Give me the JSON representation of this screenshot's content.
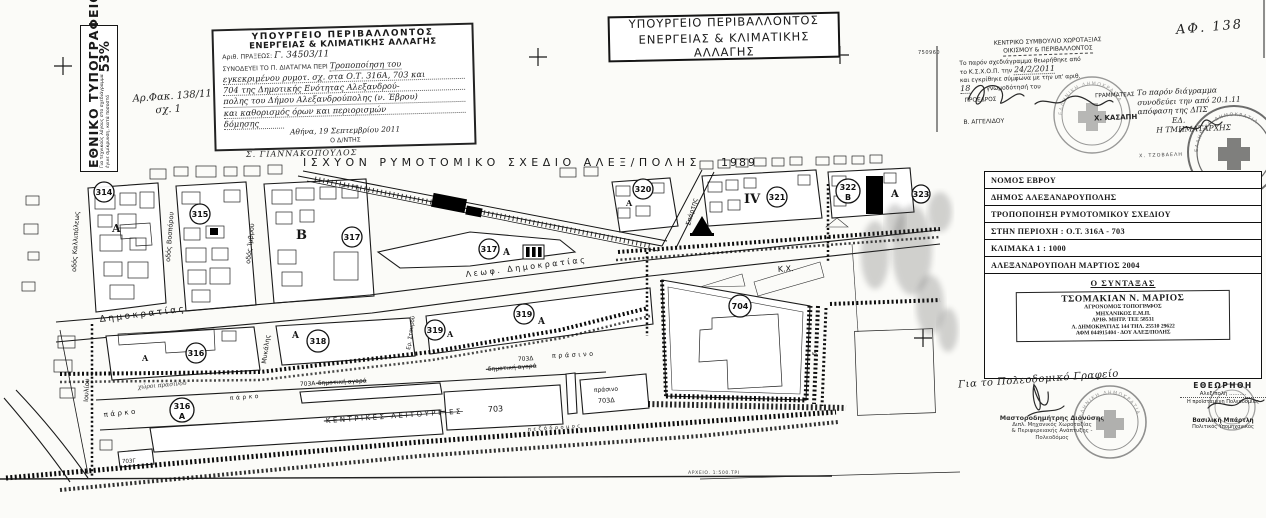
{
  "scan": {
    "archive_note": "ΑΡΧΕΙΟ. 1:500.ΤΡΙ",
    "doc_number": "750960",
    "ring_text": "ΕΛΛΗΝΙΚΗ ΔΗΜΟΚΡΑΤΙΑ"
  },
  "printing_office": {
    "title": "ΕΘΝΙΚΟ ΤΥΠΟΓΡΑΦΕΙΟ",
    "note1": "Για τεχνικούς λόγους στο σχεδιάγραμμα",
    "note2": "έγινε σμίκρυνση, κατά ποσοστό",
    "percent": "53%"
  },
  "file_ref": {
    "line1": "Αρ.Φακ. 138/11",
    "line2": "σχ. 1"
  },
  "ministry_stamp": {
    "title1": "ΥΠΟΥΡΓΕΙΟ ΠΕΡΙΒΑΛΛΟΝΤΟΣ",
    "title2": "ΕΝΕΡΓΕΙΑΣ & ΚΛΙΜΑΤΙΚΗΣ ΑΛΛΑΓΗΣ",
    "praxis_label": "Αριθ. ΠΡΑΞΕΩΣ:",
    "praxis_value": "Γ. 34503/11",
    "accompanies": "ΣΥΝΟΔΕΥΕΙ ΤΟ Π. ΔΙΑΤΑΓΜΑ ΠΕΡΙ",
    "hw1": "Τροποποίηση του",
    "hw2": "εγκεκριμένου ρυμοτ. σχ. στα Ο.Τ. 316Α, 703 και",
    "hw3": "704 της Δημοτικής Ενότητας Αλεξανδρού-",
    "hw4": "πολης του Δήμου Αλεξανδρούπολης (ν. Έβρου)",
    "hw5": "και καθορισμός όρων και περιορισμών",
    "hw6": "δόμησης",
    "date_line": "Αθήνα, 19 Σεπτεμβρίου 2011",
    "signer_title": "Ο Δ/ΝΤΗΣ",
    "signer_name": "Σ. ΓΙΑΝΝΑΚΟΠΟΥΛΟΣ"
  },
  "ministry_box": {
    "line1": "ΥΠΟΥΡΓΕΙΟ ΠΕΡΙΒΑΛΛΟΝΤΟΣ",
    "line2": "ΕΝΕΡΓΕΙΑΣ & ΚΛΙΜΑΤΙΚΗΣ ΑΛΛΑΓΗΣ"
  },
  "council_stamp": {
    "line1": "ΚΕΝΤΡΙΚΟ ΣΥΜΒΟΥΛΙΟ ΧΩΡΟΤΑΞΙΑΣ",
    "line2": "ΟΙΚΙΣΜΟΥ & ΠΕΡΙΒΑΛΛΟΝΤΟΣ",
    "body1": "Το παρόν σχεδιάγραμμα θεωρήθηκε από",
    "body2a": "το Κ.Σ.Χ.Ο.Π. την",
    "body2b": "24/2/2011",
    "body3": "και εγκρίθηκε σύμφωνα με την υπ' αριθ.",
    "body4a": "18",
    "body4b": "γνωμοδότησή του",
    "president_label": "ΠΡΟΕΔΡΟΣ",
    "secretary_label": "ΓΡΑΜΜΑΤΕΑΣ",
    "president_name": "Β. ΑΓΓΕΛΙΔΟΥ",
    "secretary_name": "Χ. ΚΑΣΑΠΗ"
  },
  "ref_number": "ΑΦ. 138",
  "side_note": {
    "line1": "Το παρόν διάγραμμα",
    "line2": "συνοδεύει την από 20.1.11",
    "line3": "απόφαση της ΔΠΣ",
    "line4": "ΕΔ.",
    "line5": "Η ΤΜΗΜΑΤΑΡΧΗΣ",
    "line6": "Χ. ΤΖΟΒΑΕΛΗ"
  },
  "map": {
    "title": "ΙΣΧΥΟΝ ΡΥΜΟΤΟΜΙΚΟ ΣΧΕΔΙΟ ΑΛΕΞ/ΠΟΛΗΣ",
    "year": "1989",
    "markers": [
      {
        "n": "314",
        "x": 104,
        "y": 192
      },
      {
        "n": "315",
        "x": 200,
        "y": 214
      },
      {
        "n": "317",
        "x": 352,
        "y": 237
      },
      {
        "n": "317",
        "x": 489,
        "y": 249
      },
      {
        "n": "320",
        "x": 643,
        "y": 189
      },
      {
        "n": "321",
        "x": 777,
        "y": 197
      },
      {
        "n": "322",
        "x": 848,
        "y": 191,
        "sub": "Β"
      },
      {
        "n": "323",
        "x": 921,
        "y": 194,
        "r": 9
      },
      {
        "n": "316",
        "x": 196,
        "y": 353
      },
      {
        "n": "318",
        "x": 318,
        "y": 341,
        "r": 11
      },
      {
        "n": "319",
        "x": 435,
        "y": 330
      },
      {
        "n": "319",
        "x": 524,
        "y": 314
      },
      {
        "n": "704",
        "x": 740,
        "y": 306,
        "r": 11
      },
      {
        "n": "316",
        "x": 182,
        "y": 410,
        "sub": "Α"
      }
    ],
    "labels": [
      {
        "t": "Δημοκρατίας",
        "x": 100,
        "y": 322,
        "r": -7,
        "s": 9,
        "c": "sp"
      },
      {
        "t": "Λεωφ.  Δημοκρατίας",
        "x": 466,
        "y": 277,
        "r": -7,
        "s": 8,
        "c": "sp"
      },
      {
        "t": "οδός Καλλιπόλεως",
        "x": 76,
        "y": 272,
        "r": -87,
        "s": 6.5
      },
      {
        "t": "οδός Βοσπόρου",
        "x": 170,
        "y": 262,
        "r": -86,
        "s": 6.5
      },
      {
        "t": "οδός Ίμβρου",
        "x": 250,
        "y": 264,
        "r": -84,
        "s": 6.5
      },
      {
        "t": "Σπάρτης",
        "x": 690,
        "y": 226,
        "r": -75,
        "s": 6.5
      },
      {
        "t": "Μυκάλης",
        "x": 266,
        "y": 364,
        "r": -82,
        "s": 6.5
      },
      {
        "t": "Ερ. Σταυρού",
        "x": 410,
        "y": 350,
        "r": -82,
        "s": 5.5
      },
      {
        "t": "Ιουλίου",
        "x": 88,
        "y": 402,
        "r": -87,
        "s": 6.5
      },
      {
        "t": "Κ.Χ.",
        "x": 778,
        "y": 272,
        "r": -4,
        "s": 8
      },
      {
        "t": "πάρκο",
        "x": 104,
        "y": 417,
        "r": -6,
        "s": 7,
        "c": "sp"
      },
      {
        "t": "πάρκο",
        "x": 230,
        "y": 400,
        "r": -4,
        "s": 6,
        "c": "sp"
      },
      {
        "t": "703",
        "x": 488,
        "y": 412,
        "r": -3,
        "s": 8
      },
      {
        "t": "703Α",
        "x": 300,
        "y": 386,
        "r": -3,
        "s": 6
      },
      {
        "t": "703Γ",
        "x": 122,
        "y": 463,
        "r": -2,
        "s": 5.5
      },
      {
        "t": "703Δ",
        "x": 518,
        "y": 361,
        "r": -3,
        "s": 6
      },
      {
        "t": "πράσινο",
        "x": 552,
        "y": 358,
        "r": -3,
        "s": 6.5,
        "c": "sp"
      },
      {
        "t": "πράσινο",
        "x": 594,
        "y": 392,
        "r": -3,
        "s": 6
      },
      {
        "t": "703Δ",
        "x": 598,
        "y": 403,
        "r": -3,
        "s": 6.5
      },
      {
        "t": "δημοτική αγορά",
        "x": 318,
        "y": 385,
        "r": -3,
        "s": 6,
        "c": "strike"
      },
      {
        "t": "δημοτική αγορά",
        "x": 488,
        "y": 371,
        "r": -4,
        "s": 6,
        "c": "strike"
      },
      {
        "t": "ΚΕΝΤΡΙΚΕΣ  ΛΕΙΤΟΥΡΓΙΕΣ",
        "x": 326,
        "y": 423,
        "r": -4,
        "s": 7,
        "c": "strike sp"
      },
      {
        "t": "πεζόδρομος",
        "x": 528,
        "y": 431,
        "r": -4,
        "s": 5,
        "c": "sp"
      },
      {
        "t": "χώροι πρασίνου",
        "x": 138,
        "y": 389,
        "r": -5,
        "s": 6,
        "c": "hwl"
      },
      {
        "t": "Α",
        "x": 112,
        "y": 232,
        "s": 11,
        "c": "zone"
      },
      {
        "t": "Β",
        "x": 296,
        "y": 239,
        "s": 13,
        "c": "zone"
      },
      {
        "t": "Α",
        "x": 503,
        "y": 255,
        "s": 9,
        "c": "zone"
      },
      {
        "t": "Α",
        "x": 447,
        "y": 337,
        "s": 8,
        "c": "zone"
      },
      {
        "t": "Α",
        "x": 538,
        "y": 324,
        "s": 9,
        "c": "zone"
      },
      {
        "t": "Α",
        "x": 142,
        "y": 361,
        "s": 8,
        "c": "zone"
      },
      {
        "t": "Α",
        "x": 292,
        "y": 338,
        "s": 9,
        "c": "zone"
      },
      {
        "t": "Α",
        "x": 626,
        "y": 206,
        "s": 8,
        "c": "zone"
      },
      {
        "t": "Α",
        "x": 891,
        "y": 197,
        "s": 10,
        "c": "zone"
      },
      {
        "t": "IV",
        "x": 744,
        "y": 203,
        "s": 13,
        "c": "zone"
      },
      {
        "t": "6",
        "x": 816,
        "y": 356,
        "r": -80,
        "s": 6
      }
    ]
  },
  "info_table": {
    "rows": [
      "ΝΟΜΟΣ ΕΒΡΟΥ",
      "ΔΗΜΟΣ ΑΛΕΞΑΝΔΡΟΥΠΟΛΗΣ",
      "ΤΡΟΠΟΠΟΙΗΣΗ ΡΥΜΟΤΟΜΙΚΟΥ ΣΧΕΔΙΟΥ",
      "ΣΤΗΝ ΠΕΡΙΟΧΗ : Ο.Τ. 316Α - 703",
      "ΚΛΙΜΑΚΑ   1 : 1000",
      "ΑΛΕΞΑΝΔΡΟΥΠΟΛΗ ΜΑΡΤΙΟΣ 2004"
    ],
    "author_header": "Ο ΣΥΝΤΑΞΑΣ",
    "author": {
      "name": "ΤΣΟΜΑΚΙΑΝ Ν. ΜΑΡΙΟΣ",
      "line2": "ΑΓΡΟΝΟΜΟΣ ΤΟΠΟΓΡΑΦΟΣ",
      "line3": "ΜΗΧΑΝΙΚΟΣ Ε.Μ.Π.",
      "line4": "ΑΡΙΘ. ΜΗΤΡ. ΤΕΕ 58531",
      "line5": "Λ. ΔΗΜΟΚΡΑΤΙΑΣ 144 ΤΗΛ. 25510 29622",
      "line6": "ΑΦΜ 044915404 - ΔΟΥ ΑΛΕΞ/ΠΟΛΗΣ"
    }
  },
  "review_left": {
    "handwritten": "Για το Πολεοδομικό Γραφείο",
    "name": "Μαστοροδημήτρης Διονύσης",
    "line2": "Διπλ. Μηχανικός Χωροταξίας",
    "line3": "& Περιφερειακής Ανάπτυξης -",
    "line4": "Πολεοδόμος"
  },
  "review_right": {
    "title": "ΕΘΕΩΡΗΘΗ",
    "place_line": "Αλεξ/πολη ..........",
    "role": "Η προϊσταμένη Πολεοδομίας",
    "name": "Βασιλική Μπάρτλη",
    "name2": "Πολιτικός Υπομηχανικός"
  }
}
